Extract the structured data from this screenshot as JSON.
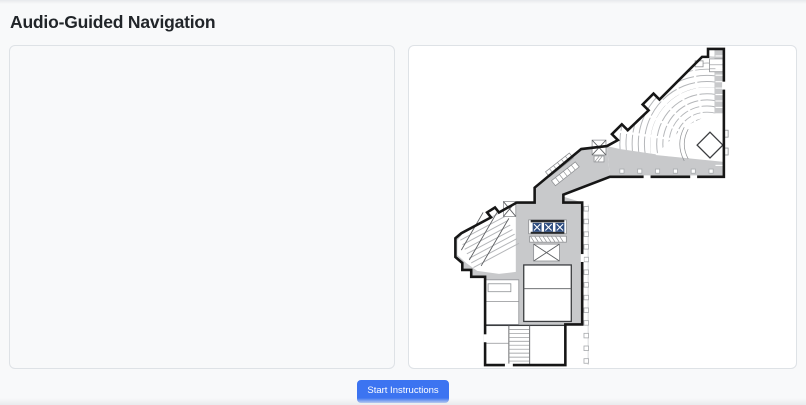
{
  "header": {
    "title": "Audio-Guided Navigation"
  },
  "footer": {
    "start_button": "Start Instructions"
  },
  "colors": {
    "accent_blue": "#3c74f1",
    "wall": "#161616",
    "circulation_gray": "#c8c9cb",
    "seat_line_gray": "#b4b6b9",
    "elevator_blue": "#2e4d80",
    "panel_border": "#dee2e6",
    "page_bg": "#f8f9fa",
    "title_color": "#212529",
    "map_bg": "#ffffff"
  }
}
